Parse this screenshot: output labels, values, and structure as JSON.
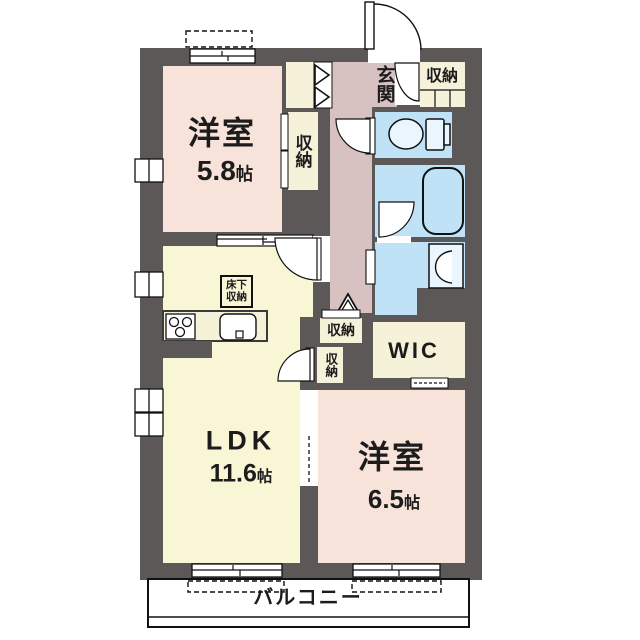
{
  "rooms": {
    "bedroom_top": {
      "label": "洋室",
      "size": "5.8",
      "unit": "帖"
    },
    "ldk": {
      "label": "LDK",
      "size": "11.6",
      "unit": "帖"
    },
    "bedroom_bottom": {
      "label": "洋室",
      "size": "6.5",
      "unit": "帖"
    },
    "entrance": {
      "label": "玄関"
    },
    "wic": {
      "label": "WIC"
    },
    "balcony": {
      "label": "バルコニー"
    }
  },
  "storages": {
    "entrance_closet": "収納",
    "bedroom_top_closet": "収納",
    "hall_closet": "収納",
    "ldk_closet": "収納",
    "underfloor_line1": "床下",
    "underfloor_line2": "収納"
  },
  "colors": {
    "wall": "#5c5858",
    "room-pink": "#f8e3da",
    "hall-mauve": "#d8c2c1",
    "ldk-cream": "#f9f6d5",
    "closet-cream": "#f6f2da",
    "wet-blue": "#bfe2f6",
    "ink": "#1c1c1c"
  }
}
